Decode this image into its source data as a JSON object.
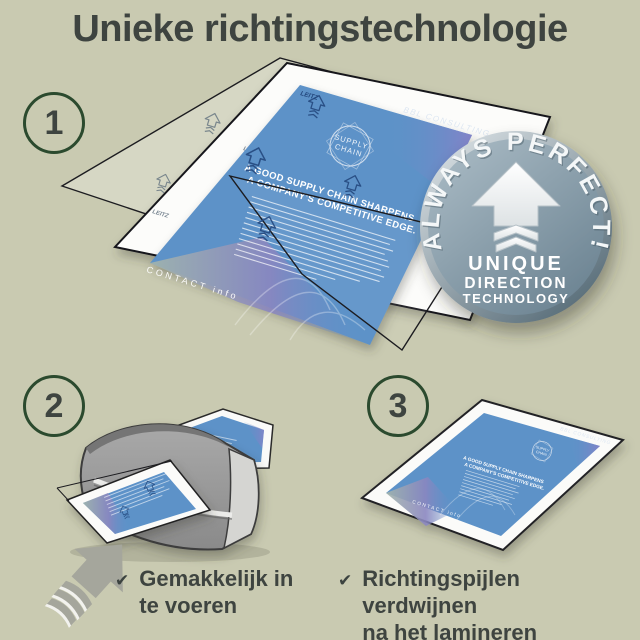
{
  "title": "Unieke richtingstechnologie",
  "steps": [
    {
      "number": "1"
    },
    {
      "number": "2"
    },
    {
      "number": "3"
    }
  ],
  "captions": {
    "check": "✔",
    "step2": [
      "Gemakkelijk in",
      "te voeren"
    ],
    "step3": [
      "Richtingspijlen verdwijnen",
      "na het lamineren"
    ]
  },
  "badge": {
    "arc": "ALWAYS PERFECT!",
    "line1": "UNIQUE",
    "line2": "DIRECTION",
    "line3": "TECHNOLOGY"
  },
  "document": {
    "brand": "BBL CONSULTING",
    "logo_line1": "SUPPLY",
    "logo_line2": "CHAIN",
    "heading1": "A GOOD SUPPLY CHAIN SHARPENS",
    "heading2": "A COMPANY'S COMPETITIVE EDGE.",
    "footer": "CONTACT info",
    "print_logo": "LEITZ"
  },
  "colors": {
    "bg": "#c9cab1",
    "ink": "#3e4440",
    "ring": "#2b4a2e",
    "check": "#3c4340",
    "doc-blue": "#5d92c8",
    "doc-print": "#24487e",
    "pouch-line": "#1c1c20",
    "icon-gray": "#a5a69c"
  }
}
